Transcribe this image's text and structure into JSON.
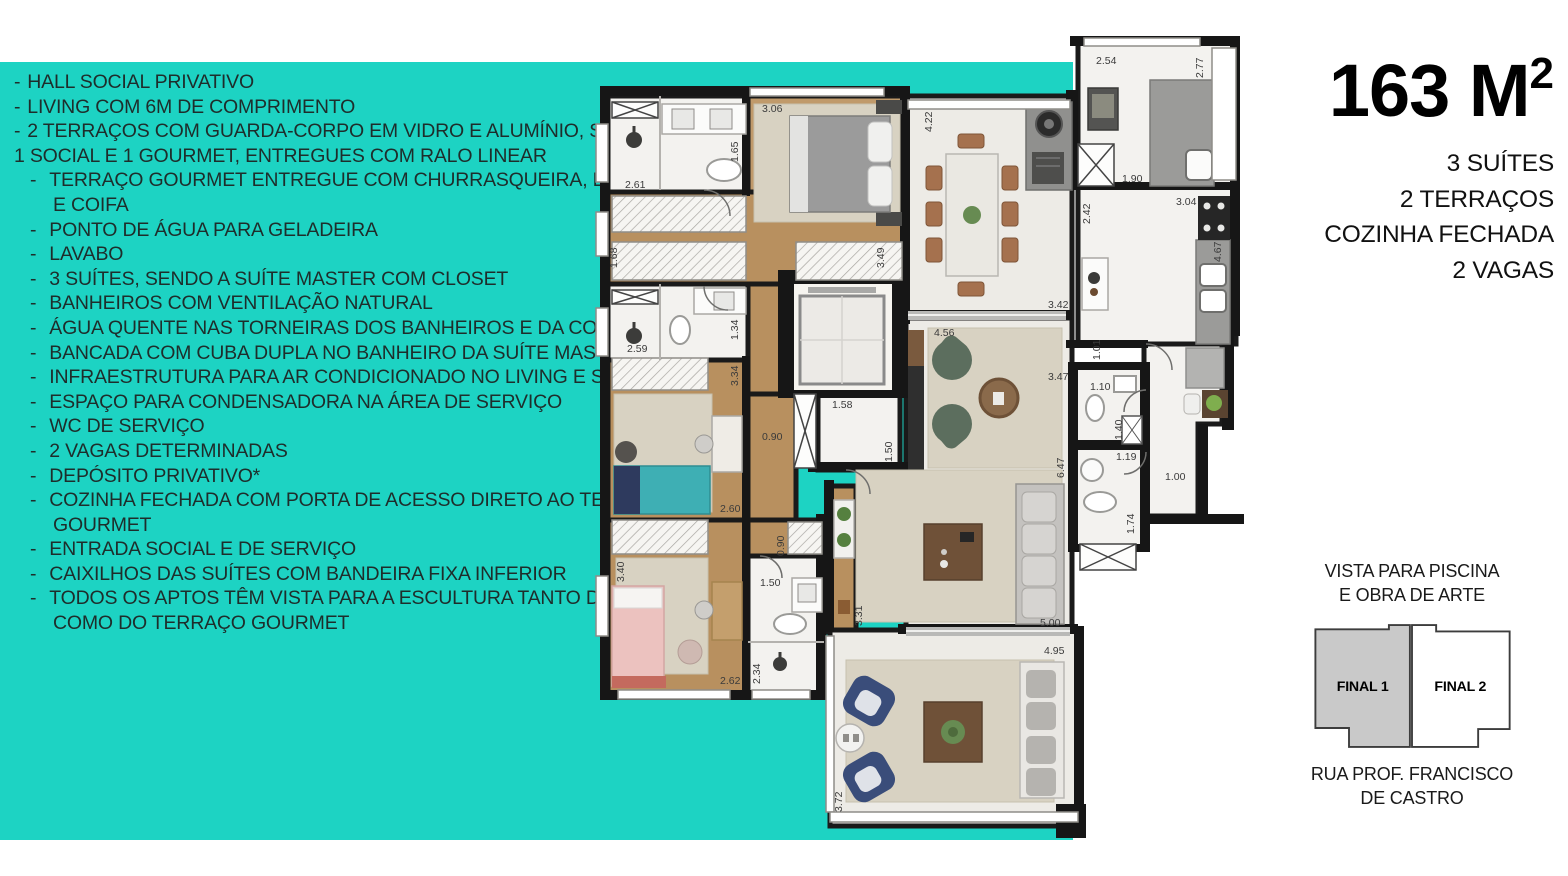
{
  "canvas": {
    "teal": "#1dd3c3",
    "text_dark": "#1e2d2b"
  },
  "features": {
    "lines": [
      {
        "b": 1,
        "i": 0,
        "t": "HALL SOCIAL PRIVATIVO"
      },
      {
        "b": 1,
        "i": 0,
        "t": "LIVING COM 6M DE COMPRIMENTO"
      },
      {
        "b": 1,
        "i": 0,
        "t": "2 TERRAÇOS COM GUARDA-CORPO EM VIDRO E ALUMÍNIO, SENDO"
      },
      {
        "b": 0,
        "i": 0,
        "t": "1 SOCIAL E 1 GOURMET, ENTREGUES COM RALO LINEAR"
      },
      {
        "b": 1,
        "i": 1,
        "t": "TERRAÇO GOURMET ENTREGUE COM CHURRASQUEIRA, BANCADA"
      },
      {
        "b": 0,
        "i": 2,
        "t": "E COIFA"
      },
      {
        "b": 1,
        "i": 1,
        "t": "PONTO DE ÁGUA PARA GELADEIRA"
      },
      {
        "b": 1,
        "i": 1,
        "t": "LAVABO"
      },
      {
        "b": 1,
        "i": 1,
        "t": "3 SUÍTES, SENDO A SUÍTE MASTER COM CLOSET"
      },
      {
        "b": 1,
        "i": 1,
        "t": "BANHEIROS COM VENTILAÇÃO NATURAL"
      },
      {
        "b": 1,
        "i": 1,
        "t": "ÁGUA QUENTE NAS TORNEIRAS DOS BANHEIROS E DA COZINHA"
      },
      {
        "b": 1,
        "i": 1,
        "t": "BANCADA COM CUBA DUPLA NO BANHEIRO DA SUÍTE MASTER"
      },
      {
        "b": 1,
        "i": 1,
        "t": "INFRAESTRUTURA PARA AR CONDICIONADO NO LIVING E SUÍTES"
      },
      {
        "b": 1,
        "i": 1,
        "t": "ESPAÇO PARA CONDENSADORA NA ÁREA DE SERVIÇO"
      },
      {
        "b": 1,
        "i": 1,
        "t": "WC DE SERVIÇO"
      },
      {
        "b": 1,
        "i": 1,
        "t": "2 VAGAS DETERMINADAS"
      },
      {
        "b": 1,
        "i": 1,
        "t": "DEPÓSITO PRIVATIVO*"
      },
      {
        "b": 1,
        "i": 1,
        "t": "COZINHA FECHADA COM PORTA DE ACESSO DIRETO AO TERRAÇO"
      },
      {
        "b": 0,
        "i": 2,
        "t": "GOURMET"
      },
      {
        "b": 1,
        "i": 1,
        "t": "ENTRADA SOCIAL E DE SERVIÇO"
      },
      {
        "b": 1,
        "i": 1,
        "t": "CAIXILHOS DAS SUÍTES COM BANDEIRA FIXA INFERIOR"
      },
      {
        "b": 1,
        "i": 1,
        "t": "TODOS OS APTOS TÊM VISTA PARA A ESCULTURA TANTO DA SUÍTE"
      },
      {
        "b": 0,
        "i": 2,
        "t": "COMO DO TERRAÇO GOURMET"
      }
    ]
  },
  "unit": {
    "area": "163 M",
    "area_sup": "2",
    "specs": [
      "3 SUÍTES",
      "2 TERRAÇOS",
      "COZINHA FECHADA",
      "2 VAGAS"
    ]
  },
  "keyplan": {
    "view_line1": "VISTA PARA PISCINA",
    "view_line2": "E OBRA DE ARTE",
    "final1": "FINAL 1",
    "final2": "FINAL 2",
    "street_line1": "RUA PROF. FRANCISCO",
    "street_line2": "DE CASTRO"
  },
  "floorplan": {
    "dimensions": [
      {
        "t": "2.61",
        "x": 625,
        "y": 188,
        "o": "h"
      },
      {
        "t": "1.65",
        "x": 738,
        "y": 162,
        "o": "v"
      },
      {
        "t": "3.06",
        "x": 762,
        "y": 112,
        "o": "h"
      },
      {
        "t": "1.68",
        "x": 617,
        "y": 268,
        "o": "v"
      },
      {
        "t": "3.49",
        "x": 884,
        "y": 268,
        "o": "v"
      },
      {
        "t": "2.59",
        "x": 627,
        "y": 352,
        "o": "h"
      },
      {
        "t": "1.34",
        "x": 738,
        "y": 340,
        "o": "v"
      },
      {
        "t": "3.34",
        "x": 738,
        "y": 386,
        "o": "v"
      },
      {
        "t": "4.22",
        "x": 932,
        "y": 132,
        "o": "v"
      },
      {
        "t": "2.54",
        "x": 1096,
        "y": 64,
        "o": "h"
      },
      {
        "t": "2.77",
        "x": 1203,
        "y": 78,
        "o": "v"
      },
      {
        "t": "1.90",
        "x": 1122,
        "y": 182,
        "o": "h"
      },
      {
        "t": "2.42",
        "x": 1090,
        "y": 224,
        "o": "v"
      },
      {
        "t": "3.04",
        "x": 1176,
        "y": 205,
        "o": "h"
      },
      {
        "t": "4.67",
        "x": 1221,
        "y": 262,
        "o": "v"
      },
      {
        "t": "3.42",
        "x": 1048,
        "y": 308,
        "o": "h"
      },
      {
        "t": "4.56",
        "x": 934,
        "y": 336,
        "o": "h"
      },
      {
        "t": "3.47",
        "x": 1048,
        "y": 380,
        "o": "h"
      },
      {
        "t": "1.01",
        "x": 1100,
        "y": 360,
        "o": "v"
      },
      {
        "t": "1.10",
        "x": 1090,
        "y": 390,
        "o": "h"
      },
      {
        "t": "1.40",
        "x": 1122,
        "y": 440,
        "o": "v"
      },
      {
        "t": "1.19",
        "x": 1116,
        "y": 460,
        "o": "h"
      },
      {
        "t": "1.00",
        "x": 1165,
        "y": 480,
        "o": "h"
      },
      {
        "t": "6.47",
        "x": 1064,
        "y": 478,
        "o": "v"
      },
      {
        "t": "1.50",
        "x": 892,
        "y": 462,
        "o": "v"
      },
      {
        "t": "1.58",
        "x": 832,
        "y": 408,
        "o": "h"
      },
      {
        "t": "1.74",
        "x": 1134,
        "y": 534,
        "o": "v"
      },
      {
        "t": "5.00",
        "x": 1040,
        "y": 626,
        "o": "h"
      },
      {
        "t": "2.60",
        "x": 720,
        "y": 512,
        "o": "h"
      },
      {
        "t": "0.90",
        "x": 762,
        "y": 440,
        "o": "h"
      },
      {
        "t": "0.90",
        "x": 784,
        "y": 556,
        "o": "v"
      },
      {
        "t": "3.40",
        "x": 624,
        "y": 582,
        "o": "v"
      },
      {
        "t": "2.62",
        "x": 720,
        "y": 684,
        "o": "h"
      },
      {
        "t": "1.50",
        "x": 760,
        "y": 586,
        "o": "h"
      },
      {
        "t": "2.34",
        "x": 760,
        "y": 684,
        "o": "v"
      },
      {
        "t": "3.31",
        "x": 862,
        "y": 626,
        "o": "v"
      },
      {
        "t": "4.95",
        "x": 1044,
        "y": 654,
        "o": "h"
      },
      {
        "t": "3.72",
        "x": 842,
        "y": 812,
        "o": "v"
      }
    ]
  }
}
